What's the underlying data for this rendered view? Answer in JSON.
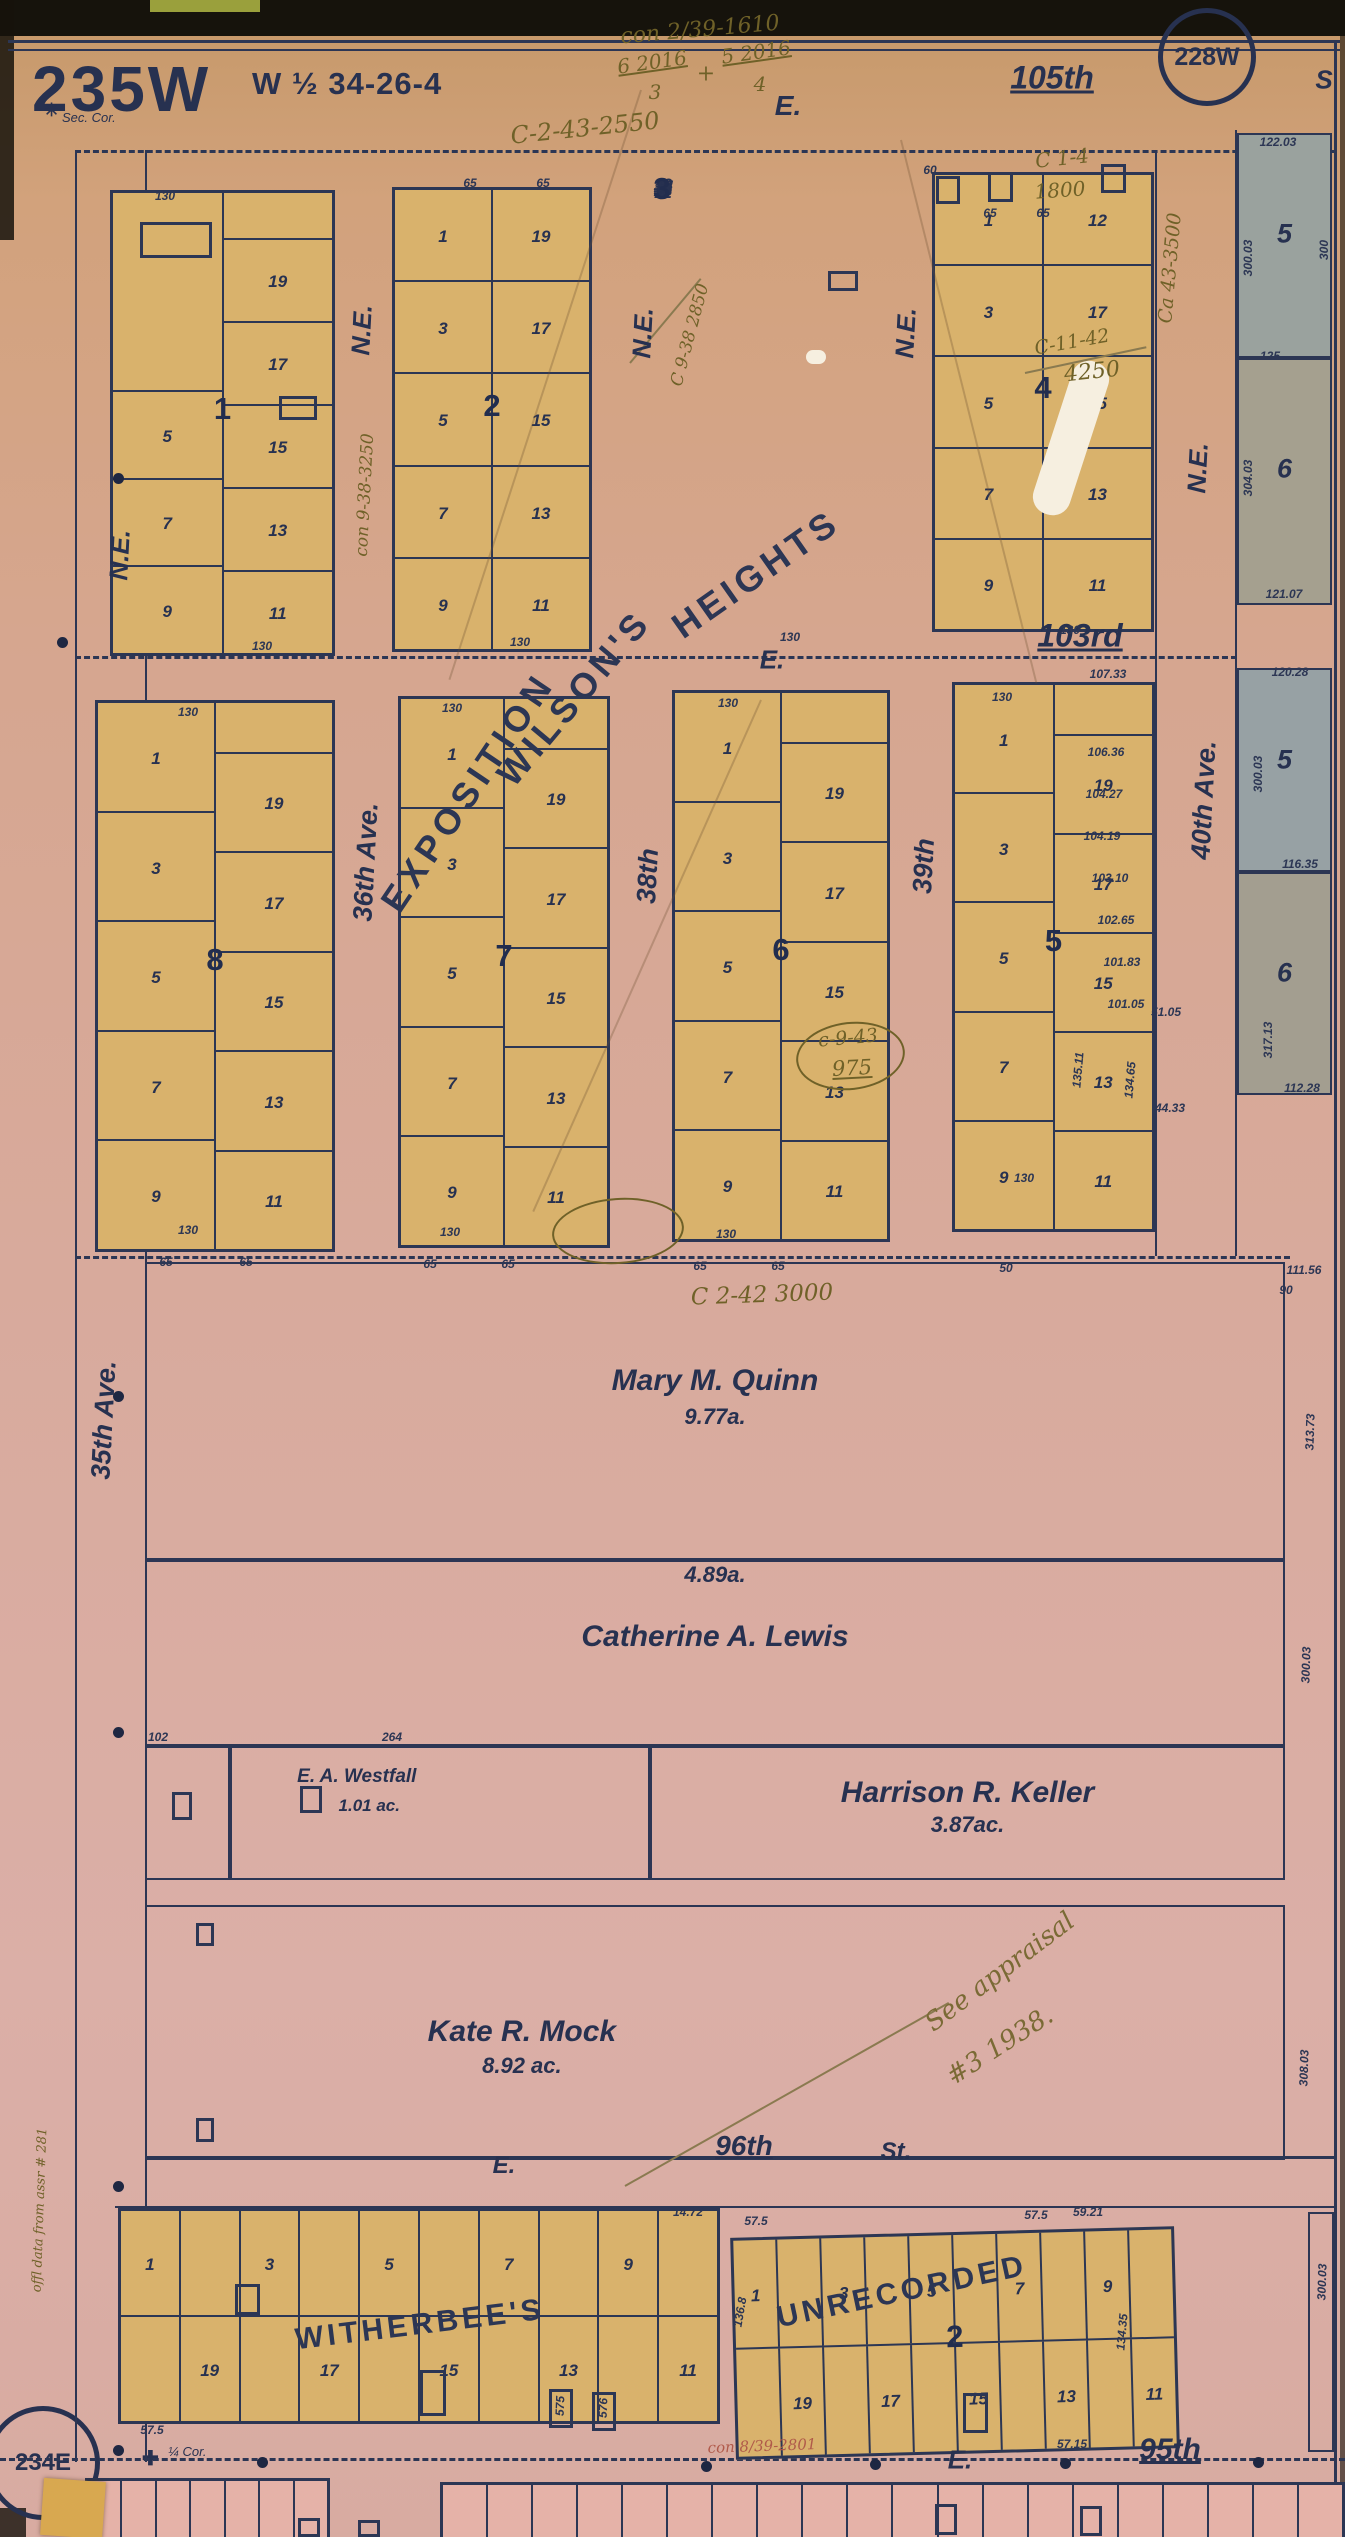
{
  "sheet": {
    "title": "235W",
    "subtitle": "W ½ 34-26-4",
    "corner_tag_top": "228W",
    "corner_tag_bottom": "234E",
    "sec_corner_label": "Sec. Cor.",
    "quarter_corner_label": "¼ Cor."
  },
  "colors": {
    "ink": "#2c3654",
    "lot_fill": "#d9b26c",
    "paper_pink": "#d8aa9c",
    "tract_gray": "#9da49e",
    "strip_pink": "#e5b2a8",
    "handwriting_olive": "#6f6128",
    "handwriting_red": "#b05a4a"
  },
  "streets": {
    "horizontal": [
      {
        "t": "E.",
        "x": 788,
        "y": 106,
        "fs": 28
      },
      {
        "t": "105th",
        "x": 1052,
        "y": 78,
        "fs": 32,
        "u": 1
      },
      {
        "t": "S",
        "x": 1324,
        "y": 80,
        "fs": 26
      },
      {
        "t": "E.",
        "x": 772,
        "y": 660,
        "fs": 26
      },
      {
        "t": "103rd",
        "x": 1080,
        "y": 636,
        "fs": 32,
        "u": 1
      },
      {
        "t": "E.",
        "x": 504,
        "y": 2166,
        "fs": 24
      },
      {
        "t": "96th",
        "x": 744,
        "y": 2146,
        "fs": 28,
        "u": 1
      },
      {
        "t": "St.",
        "x": 896,
        "y": 2152,
        "fs": 24
      },
      {
        "t": "E.",
        "x": 960,
        "y": 2460,
        "fs": 26
      },
      {
        "t": "95th",
        "x": 1170,
        "y": 2450,
        "fs": 30,
        "u": 1
      }
    ],
    "vertical": [
      {
        "t": "N.E.",
        "x": 362,
        "y": 330,
        "fs": 26
      },
      {
        "t": "N.E.",
        "x": 643,
        "y": 333,
        "fs": 26
      },
      {
        "t": "N.E.",
        "x": 906,
        "y": 333,
        "fs": 26
      },
      {
        "t": "N.E.",
        "x": 1198,
        "y": 468,
        "fs": 26
      },
      {
        "t": "N.E.",
        "x": 120,
        "y": 555,
        "fs": 26
      },
      {
        "t": "36th Ave.",
        "x": 366,
        "y": 862,
        "fs": 27
      },
      {
        "t": "38th",
        "x": 648,
        "y": 876,
        "fs": 27
      },
      {
        "t": "39th",
        "x": 924,
        "y": 866,
        "fs": 27
      },
      {
        "t": "40th Ave.",
        "x": 1204,
        "y": 800,
        "fs": 27
      },
      {
        "t": "35th Ave.",
        "x": 104,
        "y": 1420,
        "fs": 27
      }
    ]
  },
  "subdivisions": [
    {
      "t": "EXPOSITION",
      "x": 468,
      "y": 792,
      "r": -56,
      "fs": 36,
      "ls": 6
    },
    {
      "t": "WILSON'S",
      "x": 574,
      "y": 698,
      "r": -50,
      "fs": 36,
      "ls": 5
    },
    {
      "t": "HEIGHTS",
      "x": 756,
      "y": 574,
      "r": -35,
      "fs": 36,
      "ls": 5
    },
    {
      "t": "WITHERBEE'S",
      "x": 420,
      "y": 2325,
      "r": -7,
      "fs": 30,
      "ls": 4
    },
    {
      "t": "UNRECORDED",
      "x": 902,
      "y": 2292,
      "r": -12,
      "fs": 30,
      "ls": 4
    }
  ],
  "blocks": {
    "row1": [
      {
        "num": "1",
        "left": [
          "",
          "5",
          "7",
          "9"
        ],
        "lflex": [
          2.3,
          1,
          1,
          1
        ],
        "right": [
          "",
          "19",
          "17",
          "15",
          "13",
          "11"
        ],
        "rflex": [
          0.55,
          1,
          1,
          1,
          1,
          1
        ]
      },
      {
        "num": "2",
        "left": [
          "1",
          "3",
          "5",
          "7",
          "9"
        ],
        "right": [
          "19",
          "17",
          "15",
          "13",
          "11"
        ]
      },
      {
        "num": "3",
        "left": [
          "1",
          "3",
          "5",
          "7",
          "9"
        ],
        "right": [
          "19",
          "17",
          "15",
          "13",
          "11"
        ]
      },
      {
        "num": "4",
        "left": [
          "1",
          "3",
          "5",
          "7",
          "9"
        ],
        "right": [
          "12",
          "17",
          "15",
          "13",
          "11"
        ]
      }
    ],
    "row2": [
      {
        "num": "8",
        "left": [
          "1",
          "3",
          "5",
          "7",
          "9"
        ],
        "right": [
          "",
          "19",
          "17",
          "15",
          "13",
          "11"
        ],
        "rflex": [
          0.5,
          1,
          1,
          1,
          1,
          1
        ]
      },
      {
        "num": "7",
        "left": [
          "1",
          "3",
          "5",
          "7",
          "9"
        ],
        "right": [
          "",
          "19",
          "17",
          "15",
          "13",
          "11"
        ],
        "rflex": [
          0.5,
          1,
          1,
          1,
          1,
          1
        ]
      },
      {
        "num": "6",
        "left": [
          "1",
          "3",
          "5",
          "7",
          "9"
        ],
        "right": [
          "",
          "19",
          "17",
          "15",
          "13",
          "11"
        ],
        "rflex": [
          0.5,
          1,
          1,
          1,
          1,
          1
        ]
      },
      {
        "num": "5",
        "left": [
          "1",
          "3",
          "5",
          "7",
          "9"
        ],
        "right": [
          "",
          "19",
          "17",
          "15",
          "13",
          "11"
        ],
        "rflex": [
          0.5,
          1,
          1,
          1,
          1,
          1
        ]
      }
    ],
    "witherbee": {
      "top": [
        "1",
        "",
        "3",
        "",
        "5",
        "",
        "7",
        "",
        "9",
        ""
      ],
      "bottom": [
        "",
        "19",
        "",
        "17",
        "",
        "15",
        "",
        "13",
        "",
        "11"
      ]
    },
    "unrecorded": {
      "num": "2",
      "top": [
        "1",
        "",
        "3",
        "",
        "5",
        "",
        "7",
        "",
        "9",
        ""
      ],
      "bottom": [
        "",
        "19",
        "",
        "17",
        "",
        "15",
        "",
        "13",
        "",
        "11"
      ]
    }
  },
  "parcels": [
    {
      "name": "Mary M. Quinn",
      "acreage": "9.77a."
    },
    {
      "name": "Catherine A. Lewis",
      "acreage": "4.89a."
    },
    {
      "name": "E. A. Westfall",
      "acreage": "1.01 ac."
    },
    {
      "name": "Harrison R. Keller",
      "acreage": "3.87ac."
    },
    {
      "name": "Kate R. Mock",
      "acreage": "8.92 ac."
    }
  ],
  "east_tracts": [
    {
      "num": "5"
    },
    {
      "num": "6"
    },
    {
      "num": "5"
    },
    {
      "num": "6"
    }
  ],
  "annotations": [
    {
      "t": "con 2/39-1610",
      "x": 700,
      "y": 30,
      "r": -5,
      "c": "olive",
      "fs": 22
    },
    {
      "t": "6 2016",
      "x": 652,
      "y": 62,
      "r": -8,
      "c": "olive",
      "fs": 20,
      "u": 1
    },
    {
      "t": "3",
      "x": 655,
      "y": 92,
      "r": 0,
      "c": "olive",
      "fs": 20
    },
    {
      "t": "+",
      "x": 706,
      "y": 74,
      "r": 0,
      "c": "olive",
      "fs": 22
    },
    {
      "t": "5 2016",
      "x": 756,
      "y": 52,
      "r": -8,
      "c": "olive",
      "fs": 20,
      "u": 1
    },
    {
      "t": "4",
      "x": 760,
      "y": 84,
      "r": 0,
      "c": "olive",
      "fs": 20
    },
    {
      "t": "C-2-43-2550",
      "x": 585,
      "y": 128,
      "r": -6,
      "c": "olive",
      "fs": 24
    },
    {
      "t": "con 9-38-3250",
      "x": 365,
      "y": 495,
      "r": -87,
      "c": "olive",
      "fs": 17
    },
    {
      "t": "C 9-38 2850",
      "x": 690,
      "y": 335,
      "r": -75,
      "c": "olive",
      "fs": 17
    },
    {
      "t": "C 1-4",
      "x": 1062,
      "y": 158,
      "r": -6,
      "c": "olive",
      "fs": 20
    },
    {
      "t": "1800",
      "x": 1060,
      "y": 190,
      "r": -4,
      "c": "olive",
      "fs": 20
    },
    {
      "t": "C-11-42",
      "x": 1072,
      "y": 342,
      "r": -10,
      "c": "olive",
      "fs": 19
    },
    {
      "t": "4250",
      "x": 1092,
      "y": 372,
      "r": -6,
      "c": "olive",
      "fs": 22
    },
    {
      "t": "Ca 43-3500",
      "x": 1170,
      "y": 268,
      "r": -85,
      "c": "olive",
      "fs": 19
    },
    {
      "t": "C 2-42 3000",
      "x": 762,
      "y": 1295,
      "r": -2,
      "c": "olive",
      "fs": 23
    },
    {
      "t": "c-9-43",
      "x": 848,
      "y": 1038,
      "r": -5,
      "c": "olive",
      "fs": 19
    },
    {
      "t": "975",
      "x": 852,
      "y": 1068,
      "r": -3,
      "c": "olive",
      "fs": 21,
      "u": 1
    },
    {
      "t": "See appraisal",
      "x": 1000,
      "y": 1972,
      "r": -37,
      "c": "olive-script",
      "fs": 26
    },
    {
      "t": "#3 1938.",
      "x": 1000,
      "y": 2046,
      "r": -33,
      "c": "olive-script",
      "fs": 26
    },
    {
      "t": "con 8/39-2801",
      "x": 762,
      "y": 2446,
      "r": -2,
      "c": "red",
      "fs": 15
    },
    {
      "t": "offl data from assr # 281",
      "x": 40,
      "y": 2210,
      "r": -88,
      "c": "olive",
      "fs": 13
    }
  ],
  "measurements": [
    {
      "t": "130",
      "x": 165,
      "y": 196
    },
    {
      "t": "65",
      "x": 470,
      "y": 183
    },
    {
      "t": "65",
      "x": 543,
      "y": 183
    },
    {
      "t": "60",
      "x": 930,
      "y": 170
    },
    {
      "t": "65",
      "x": 990,
      "y": 213
    },
    {
      "t": "65",
      "x": 1043,
      "y": 213
    },
    {
      "t": "130",
      "x": 262,
      "y": 646
    },
    {
      "t": "130",
      "x": 520,
      "y": 642
    },
    {
      "t": "130",
      "x": 790,
      "y": 637
    },
    {
      "t": "130",
      "x": 1070,
      "y": 630
    },
    {
      "t": "130",
      "x": 188,
      "y": 712
    },
    {
      "t": "130",
      "x": 452,
      "y": 708
    },
    {
      "t": "130",
      "x": 728,
      "y": 703
    },
    {
      "t": "130",
      "x": 1002,
      "y": 697
    },
    {
      "t": "107.33",
      "x": 1108,
      "y": 674
    },
    {
      "t": "106.36",
      "x": 1106,
      "y": 752
    },
    {
      "t": "104.27",
      "x": 1104,
      "y": 794
    },
    {
      "t": "104.19",
      "x": 1102,
      "y": 836
    },
    {
      "t": "103.10",
      "x": 1110,
      "y": 878
    },
    {
      "t": "102.65",
      "x": 1116,
      "y": 920
    },
    {
      "t": "101.83",
      "x": 1122,
      "y": 962
    },
    {
      "t": "101.05",
      "x": 1126,
      "y": 1004
    },
    {
      "t": "51.05",
      "x": 1166,
      "y": 1012
    },
    {
      "t": "135.11",
      "x": 1078,
      "y": 1070,
      "r": -85
    },
    {
      "t": "134.65",
      "x": 1130,
      "y": 1080,
      "r": -85
    },
    {
      "t": "44.33",
      "x": 1170,
      "y": 1108
    },
    {
      "t": "130",
      "x": 188,
      "y": 1230
    },
    {
      "t": "65",
      "x": 166,
      "y": 1262
    },
    {
      "t": "65",
      "x": 246,
      "y": 1262
    },
    {
      "t": "130",
      "x": 450,
      "y": 1232
    },
    {
      "t": "65",
      "x": 430,
      "y": 1264
    },
    {
      "t": "65",
      "x": 508,
      "y": 1264
    },
    {
      "t": "130",
      "x": 726,
      "y": 1234
    },
    {
      "t": "65",
      "x": 700,
      "y": 1266
    },
    {
      "t": "65",
      "x": 778,
      "y": 1266
    },
    {
      "t": "50",
      "x": 1006,
      "y": 1268
    },
    {
      "t": "130",
      "x": 1024,
      "y": 1178
    },
    {
      "t": "122.03",
      "x": 1278,
      "y": 142
    },
    {
      "t": "300",
      "x": 1324,
      "y": 250,
      "r": -90
    },
    {
      "t": "300.03",
      "x": 1248,
      "y": 258,
      "r": -90
    },
    {
      "t": "125",
      "x": 1270,
      "y": 356
    },
    {
      "t": "304.03",
      "x": 1248,
      "y": 478,
      "r": -90
    },
    {
      "t": "121.07",
      "x": 1284,
      "y": 594
    },
    {
      "t": "120.28",
      "x": 1290,
      "y": 672
    },
    {
      "t": "300.03",
      "x": 1258,
      "y": 774,
      "r": -90
    },
    {
      "t": "116.35",
      "x": 1300,
      "y": 864
    },
    {
      "t": "317.13",
      "x": 1268,
      "y": 1040,
      "r": -90
    },
    {
      "t": "112.28",
      "x": 1302,
      "y": 1088
    },
    {
      "t": "111.56",
      "x": 1304,
      "y": 1270
    },
    {
      "t": "90",
      "x": 1286,
      "y": 1290
    },
    {
      "t": "313.73",
      "x": 1310,
      "y": 1432,
      "r": -88
    },
    {
      "t": "300.03",
      "x": 1306,
      "y": 1665,
      "r": -88
    },
    {
      "t": "308.03",
      "x": 1304,
      "y": 2068,
      "r": -88
    },
    {
      "t": "102",
      "x": 158,
      "y": 1737
    },
    {
      "t": "264",
      "x": 392,
      "y": 1737
    },
    {
      "t": "14.72",
      "x": 688,
      "y": 2212
    },
    {
      "t": "57.5",
      "x": 756,
      "y": 2221
    },
    {
      "t": "57.5",
      "x": 1036,
      "y": 2215
    },
    {
      "t": "59.21",
      "x": 1088,
      "y": 2212
    },
    {
      "t": "136.8",
      "x": 740,
      "y": 2312,
      "r": -80
    },
    {
      "t": "134.35",
      "x": 1122,
      "y": 2332,
      "r": -85
    },
    {
      "t": "575",
      "x": 560,
      "y": 2406,
      "r": -88
    },
    {
      "t": "576",
      "x": 603,
      "y": 2408,
      "r": -88
    },
    {
      "t": "57.5",
      "x": 152,
      "y": 2430
    },
    {
      "t": "57.15",
      "x": 1072,
      "y": 2444
    },
    {
      "t": "300.03",
      "x": 1322,
      "y": 2282,
      "r": -88
    }
  ],
  "buildings": [
    {
      "x": 140,
      "y": 222,
      "w": 72,
      "h": 36
    },
    {
      "x": 279,
      "y": 396,
      "w": 38,
      "h": 24
    },
    {
      "x": 828,
      "y": 271,
      "w": 30,
      "h": 20
    },
    {
      "x": 936,
      "y": 176,
      "w": 24,
      "h": 28
    },
    {
      "x": 988,
      "y": 172,
      "w": 25,
      "h": 30
    },
    {
      "x": 1101,
      "y": 164,
      "w": 25,
      "h": 29
    },
    {
      "x": 300,
      "y": 1786,
      "w": 22,
      "h": 27
    },
    {
      "x": 172,
      "y": 1792,
      "w": 20,
      "h": 28
    },
    {
      "x": 196,
      "y": 1923,
      "w": 18,
      "h": 23
    },
    {
      "x": 196,
      "y": 2118,
      "w": 18,
      "h": 24
    },
    {
      "x": 235,
      "y": 2284,
      "w": 25,
      "h": 31
    },
    {
      "x": 420,
      "y": 2370,
      "w": 26,
      "h": 46
    },
    {
      "x": 549,
      "y": 2389,
      "w": 24,
      "h": 39
    },
    {
      "x": 592,
      "y": 2392,
      "w": 24,
      "h": 39
    },
    {
      "x": 963,
      "y": 2393,
      "w": 25,
      "h": 40
    },
    {
      "x": 935,
      "y": 2504,
      "w": 22,
      "h": 31
    },
    {
      "x": 1080,
      "y": 2506,
      "w": 22,
      "h": 30
    },
    {
      "x": 298,
      "y": 2518,
      "w": 22,
      "h": 19
    },
    {
      "x": 358,
      "y": 2520,
      "w": 22,
      "h": 17
    }
  ],
  "dots": [
    {
      "x": 118,
      "y": 478
    },
    {
      "x": 62,
      "y": 642
    },
    {
      "x": 118,
      "y": 1396
    },
    {
      "x": 118,
      "y": 1732
    },
    {
      "x": 118,
      "y": 2186
    },
    {
      "x": 118,
      "y": 2450
    },
    {
      "x": 262,
      "y": 2462
    },
    {
      "x": 706,
      "y": 2466
    },
    {
      "x": 875,
      "y": 2464
    },
    {
      "x": 1065,
      "y": 2463
    },
    {
      "x": 1258,
      "y": 2462
    }
  ]
}
